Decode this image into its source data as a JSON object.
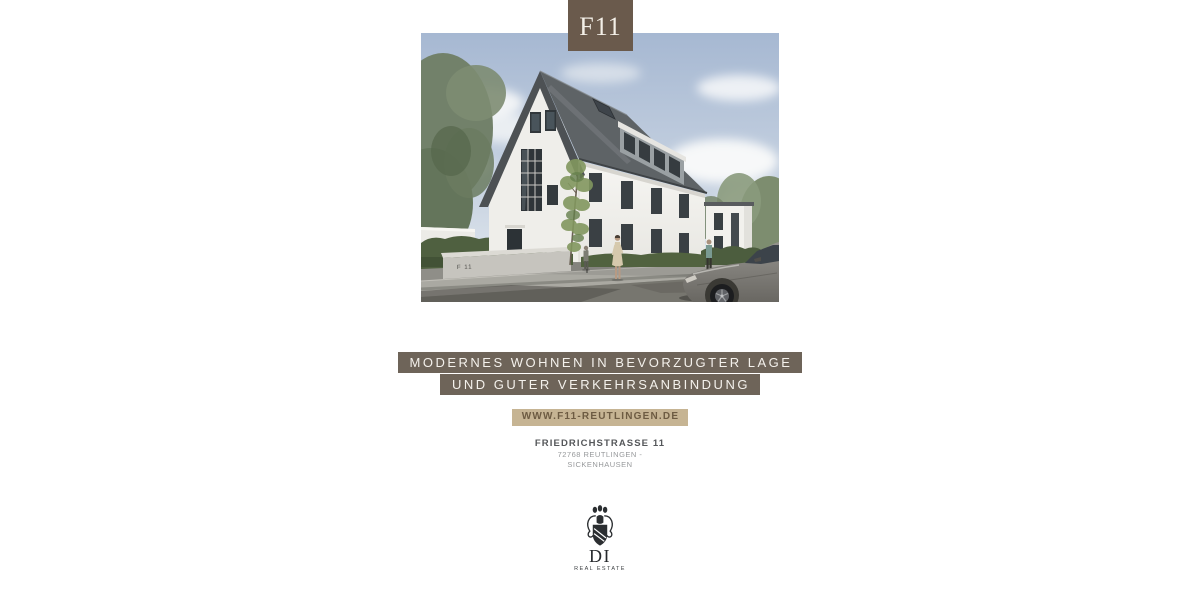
{
  "brand": {
    "project_code": "F11",
    "logo_monogram": "DI",
    "logo_subtitle": "REAL ESTATE"
  },
  "headline": {
    "line1": "MODERNES WOHNEN IN BEVORZUGTER LAGE",
    "line2": "UND GUTER VERKEHRSANBINDUNG"
  },
  "website": {
    "label": "WWW.F11-REUTLINGEN.DE"
  },
  "address": {
    "street": "FRIEDRICHSTRASSE 11",
    "line2": "72768 REUTLINGEN -",
    "line3": "SICKENHAUSEN"
  },
  "hero": {
    "wall_sign": "F 11"
  },
  "colors": {
    "page_bg": "#ffffff",
    "brand_box": "#6a5a4c",
    "banner_bg": "#6e6459",
    "banner_text": "#f4f1ec",
    "website_bg": "#c6b493",
    "website_text": "#6d5b42",
    "address_dark": "#55575a",
    "address_light": "#97999b",
    "sky_top": "#a6b8d2",
    "sky_bottom": "#e9edf1",
    "roof": "#5e6366",
    "wall_white": "#f5f4f1",
    "hedge_green": "#4e5f3d",
    "street_gray": "#77766f",
    "car_gray": "#8b8984"
  }
}
